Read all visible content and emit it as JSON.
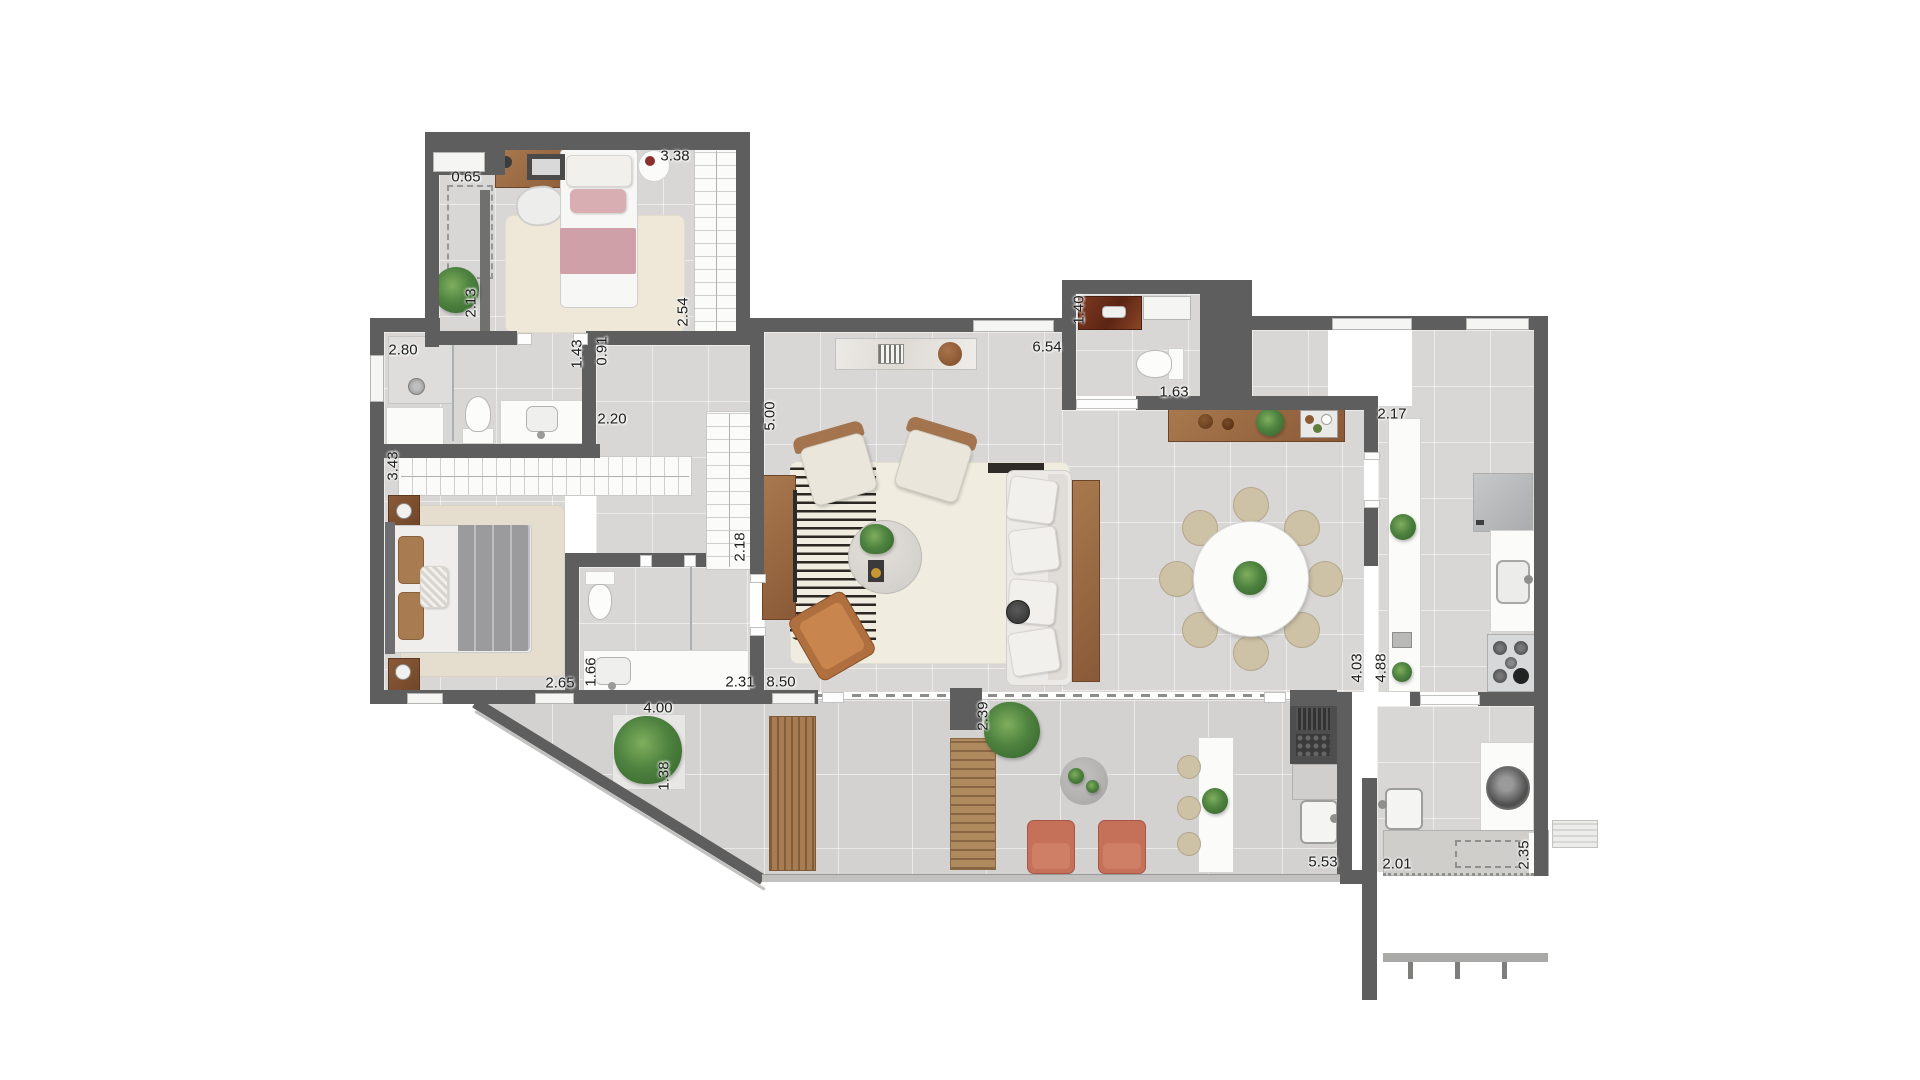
{
  "dimensions": [
    {
      "label": "0.65",
      "x": 466,
      "y": 177,
      "vertical": false
    },
    {
      "label": "3.38",
      "x": 675,
      "y": 156,
      "vertical": false
    },
    {
      "label": "2.13",
      "x": 471,
      "y": 303,
      "vertical": true
    },
    {
      "label": "2.54",
      "x": 683,
      "y": 312,
      "vertical": true
    },
    {
      "label": "2.80",
      "x": 403,
      "y": 350,
      "vertical": false
    },
    {
      "label": "1.43",
      "x": 577,
      "y": 354,
      "vertical": true
    },
    {
      "label": "0.91",
      "x": 602,
      "y": 351,
      "vertical": true
    },
    {
      "label": "2.20",
      "x": 612,
      "y": 419,
      "vertical": false
    },
    {
      "label": "5.00",
      "x": 770,
      "y": 416,
      "vertical": true
    },
    {
      "label": "2.18",
      "x": 740,
      "y": 547,
      "vertical": true
    },
    {
      "label": "3.43",
      "x": 393,
      "y": 466,
      "vertical": true
    },
    {
      "label": "2.65",
      "x": 560,
      "y": 683,
      "vertical": false
    },
    {
      "label": "1.66",
      "x": 591,
      "y": 672,
      "vertical": true
    },
    {
      "label": "2.31",
      "x": 740,
      "y": 682,
      "vertical": false
    },
    {
      "label": "8.50",
      "x": 781,
      "y": 682,
      "vertical": false
    },
    {
      "label": "6.54",
      "x": 1047,
      "y": 347,
      "vertical": false
    },
    {
      "label": "1.40",
      "x": 1079,
      "y": 310,
      "vertical": true
    },
    {
      "label": "1.63",
      "x": 1174,
      "y": 392,
      "vertical": false
    },
    {
      "label": "2.17",
      "x": 1392,
      "y": 414,
      "vertical": false
    },
    {
      "label": "2.39",
      "x": 983,
      "y": 716,
      "vertical": true
    },
    {
      "label": "4.03",
      "x": 1357,
      "y": 668,
      "vertical": true
    },
    {
      "label": "4.88",
      "x": 1381,
      "y": 668,
      "vertical": true
    },
    {
      "label": "4.00",
      "x": 658,
      "y": 708,
      "vertical": false
    },
    {
      "label": "1.38",
      "x": 664,
      "y": 776,
      "vertical": true
    },
    {
      "label": "5.53",
      "x": 1323,
      "y": 862,
      "vertical": false
    },
    {
      "label": "2.01",
      "x": 1397,
      "y": 864,
      "vertical": false
    },
    {
      "label": "2.35",
      "x": 1524,
      "y": 855,
      "vertical": true
    }
  ],
  "colors": {
    "wall": "#5e5e5e",
    "floor": "#d8d7d5",
    "wood": "#9c6b44",
    "accent_pink": "#cfa0a8",
    "accent_terracotta": "#c57058",
    "plant_green": "#3f7233",
    "rug_cream": "#efe9da"
  }
}
